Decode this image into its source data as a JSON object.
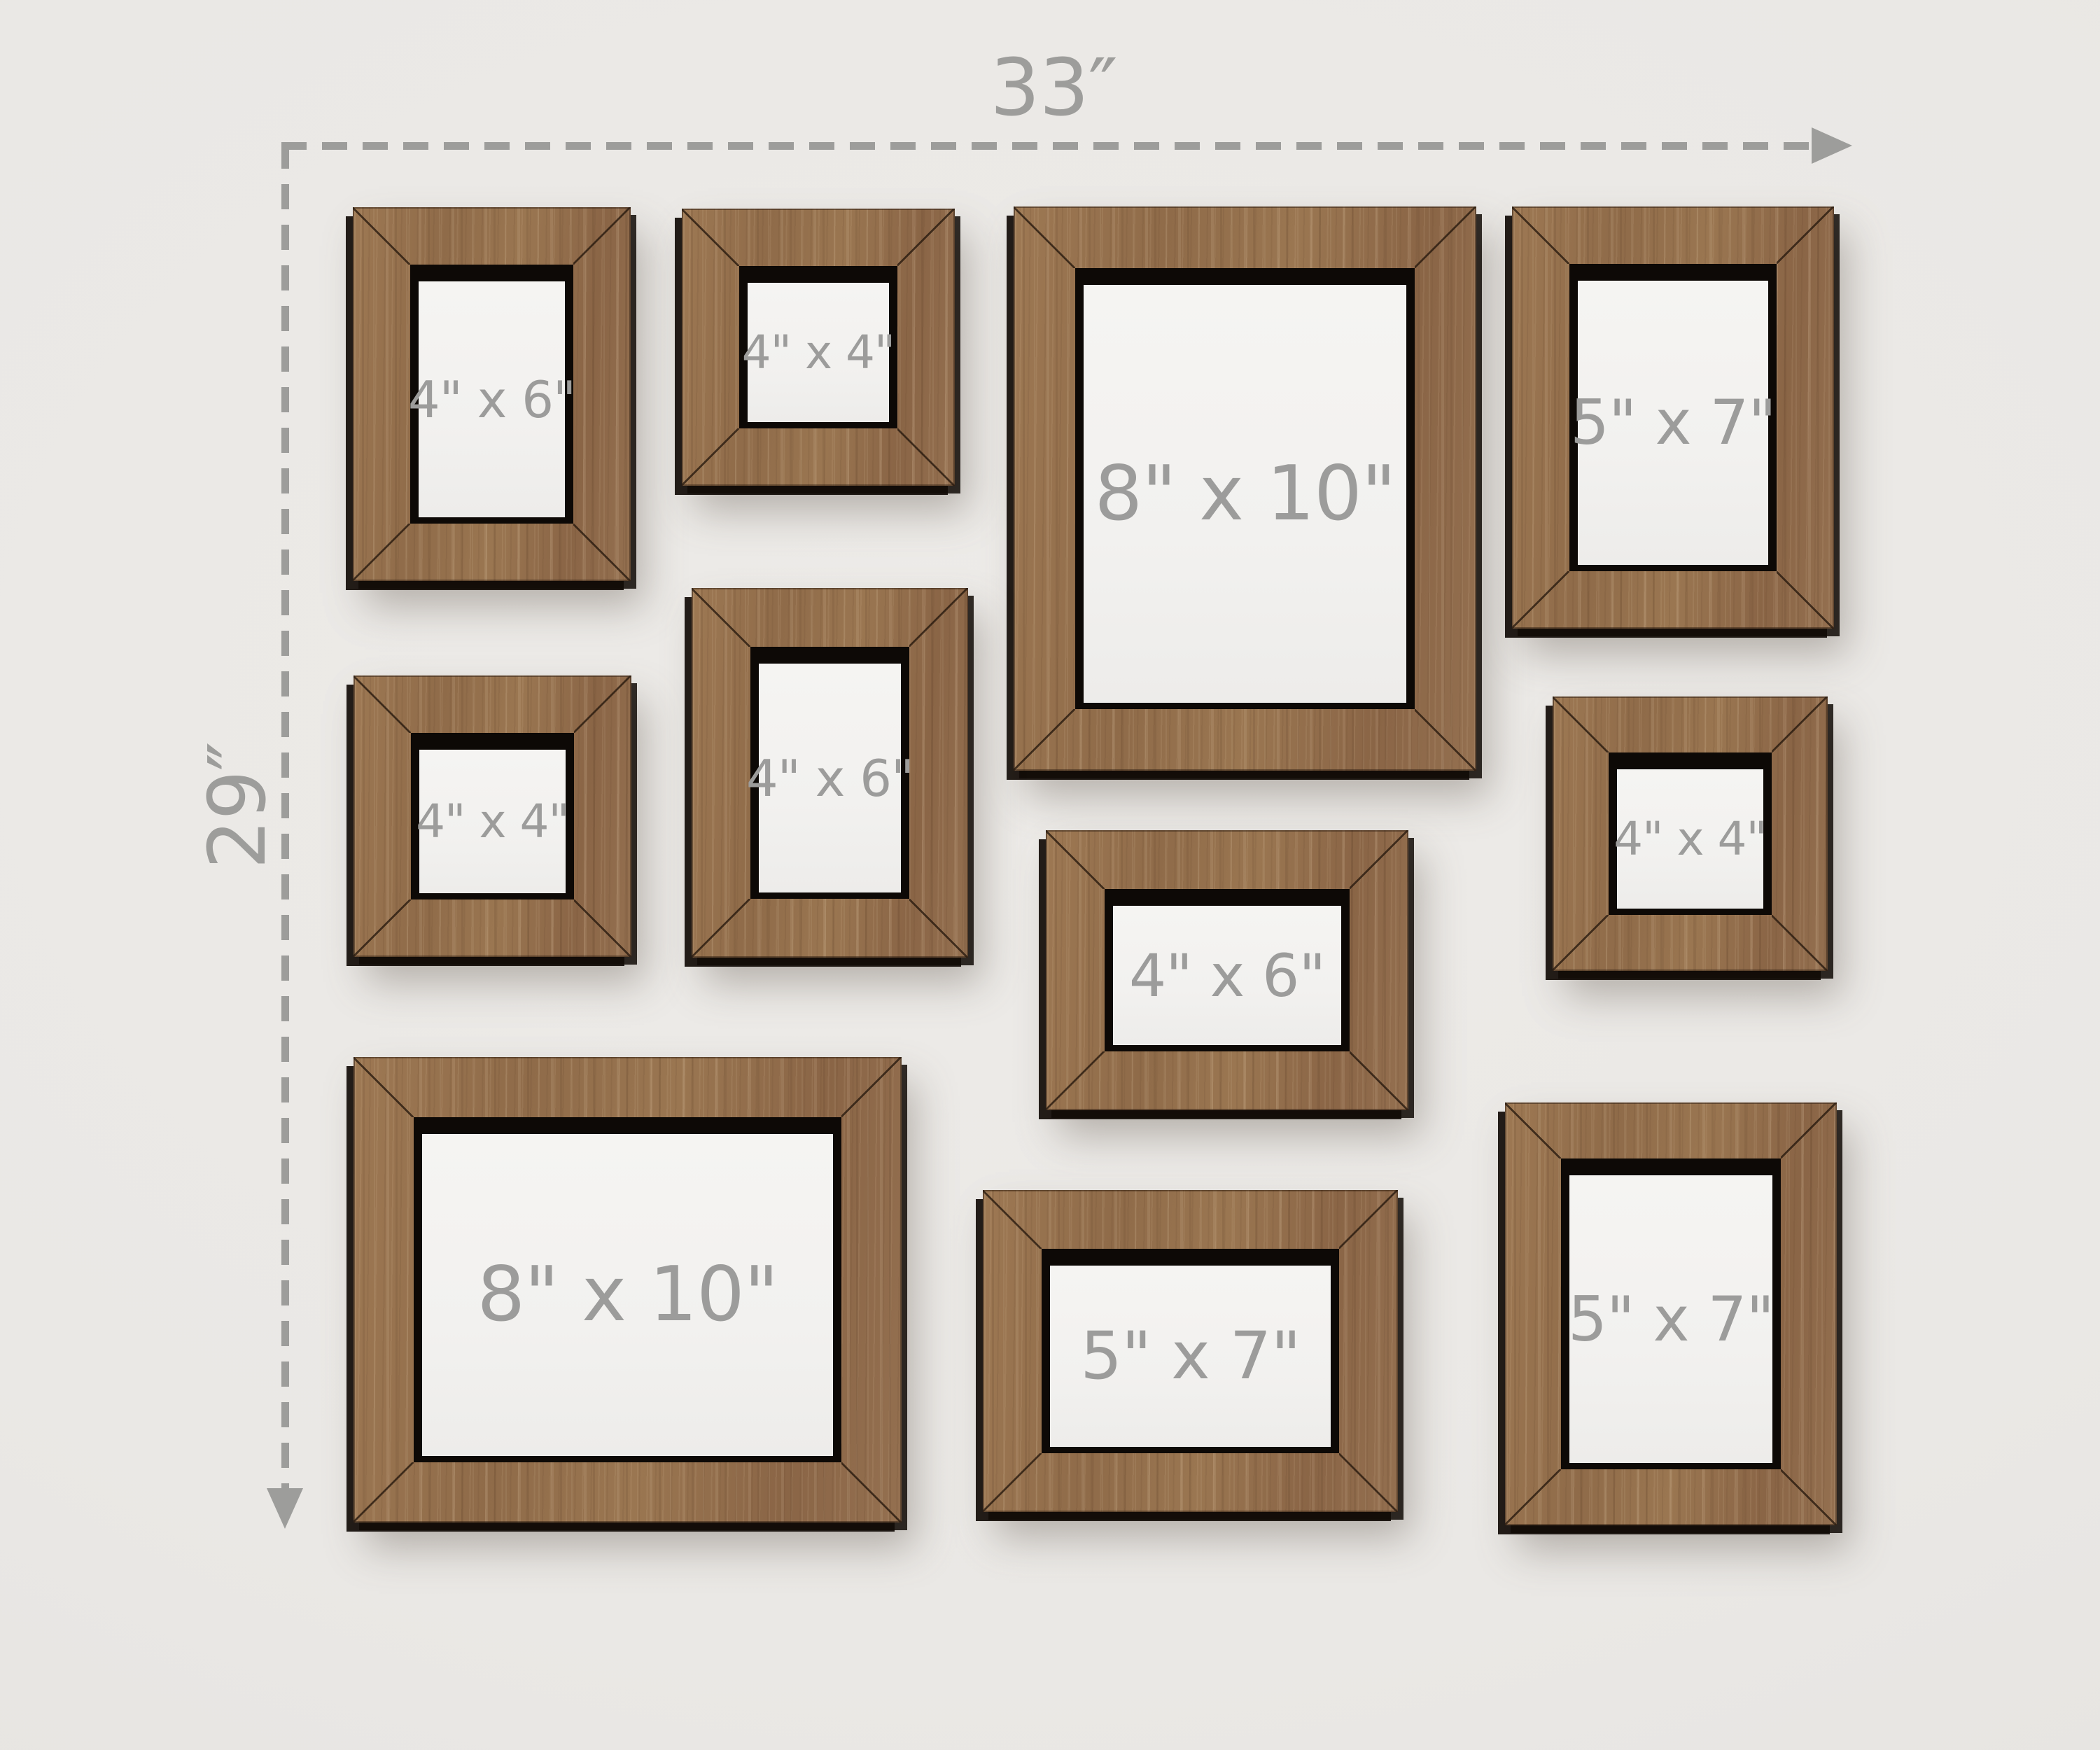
{
  "dimensions": {
    "width_label": "33″",
    "height_label": "29″"
  },
  "frames": [
    {
      "label": "4\" x 6\"",
      "orientation": "portrait",
      "position": "top-left"
    },
    {
      "label": "4\" x 4\"",
      "orientation": "square",
      "position": "top"
    },
    {
      "label": "8\" x 10\"",
      "orientation": "portrait",
      "position": "top-center"
    },
    {
      "label": "5\" x 7\"",
      "orientation": "portrait",
      "position": "top-right"
    },
    {
      "label": "4\" x 4\"",
      "orientation": "square",
      "position": "middle-left"
    },
    {
      "label": "4\" x 6\"",
      "orientation": "portrait",
      "position": "middle"
    },
    {
      "label": "4\" x 6\"",
      "orientation": "landscape",
      "position": "center"
    },
    {
      "label": "4\" x 4\"",
      "orientation": "square",
      "position": "middle-right"
    },
    {
      "label": "8\" x 10\"",
      "orientation": "landscape",
      "position": "bottom-left"
    },
    {
      "label": "5\" x 7\"",
      "orientation": "landscape",
      "position": "bottom-center"
    },
    {
      "label": "5\" x 7\"",
      "orientation": "portrait",
      "position": "bottom-right"
    }
  ],
  "colors": {
    "wood": "#96714e",
    "wall": "#e9e7e4",
    "frame_label": "#9c9c9b",
    "dimension": "#9d9d9b",
    "inner_shadow": "#0d0906",
    "mat": "#f3f2f0"
  }
}
